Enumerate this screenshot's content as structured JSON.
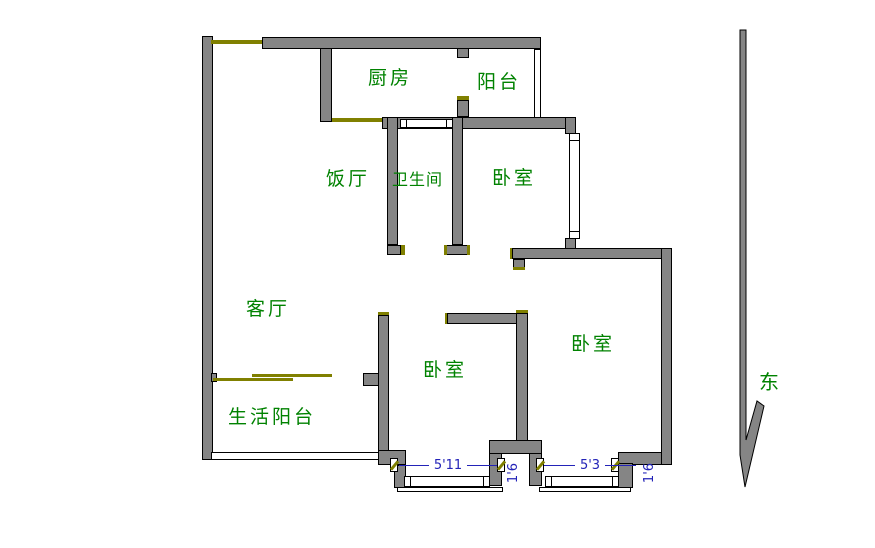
{
  "plan": {
    "rooms": [
      {
        "id": "kitchen",
        "label": "厨房"
      },
      {
        "id": "balcony",
        "label": "阳台"
      },
      {
        "id": "dining",
        "label": "饭厅"
      },
      {
        "id": "bathroom",
        "label": "卫生间"
      },
      {
        "id": "bedroom-top",
        "label": "卧室"
      },
      {
        "id": "living-room",
        "label": "客厅"
      },
      {
        "id": "service-balcony",
        "label": "生活阳台"
      },
      {
        "id": "bedroom-middle",
        "label": "卧室"
      },
      {
        "id": "bedroom-right",
        "label": "卧室"
      }
    ],
    "compass": {
      "east": "东"
    },
    "dimensions": {
      "window1_width": "5'11",
      "pier1_width": "1'6",
      "window2_width": "5'3",
      "pier2_width": "1'6"
    },
    "colors": {
      "wall_fill": "#858585",
      "wall_outline": "#000000",
      "door_marker": "#808000",
      "room_label": "#008200",
      "dimension": "#2323b8"
    }
  }
}
